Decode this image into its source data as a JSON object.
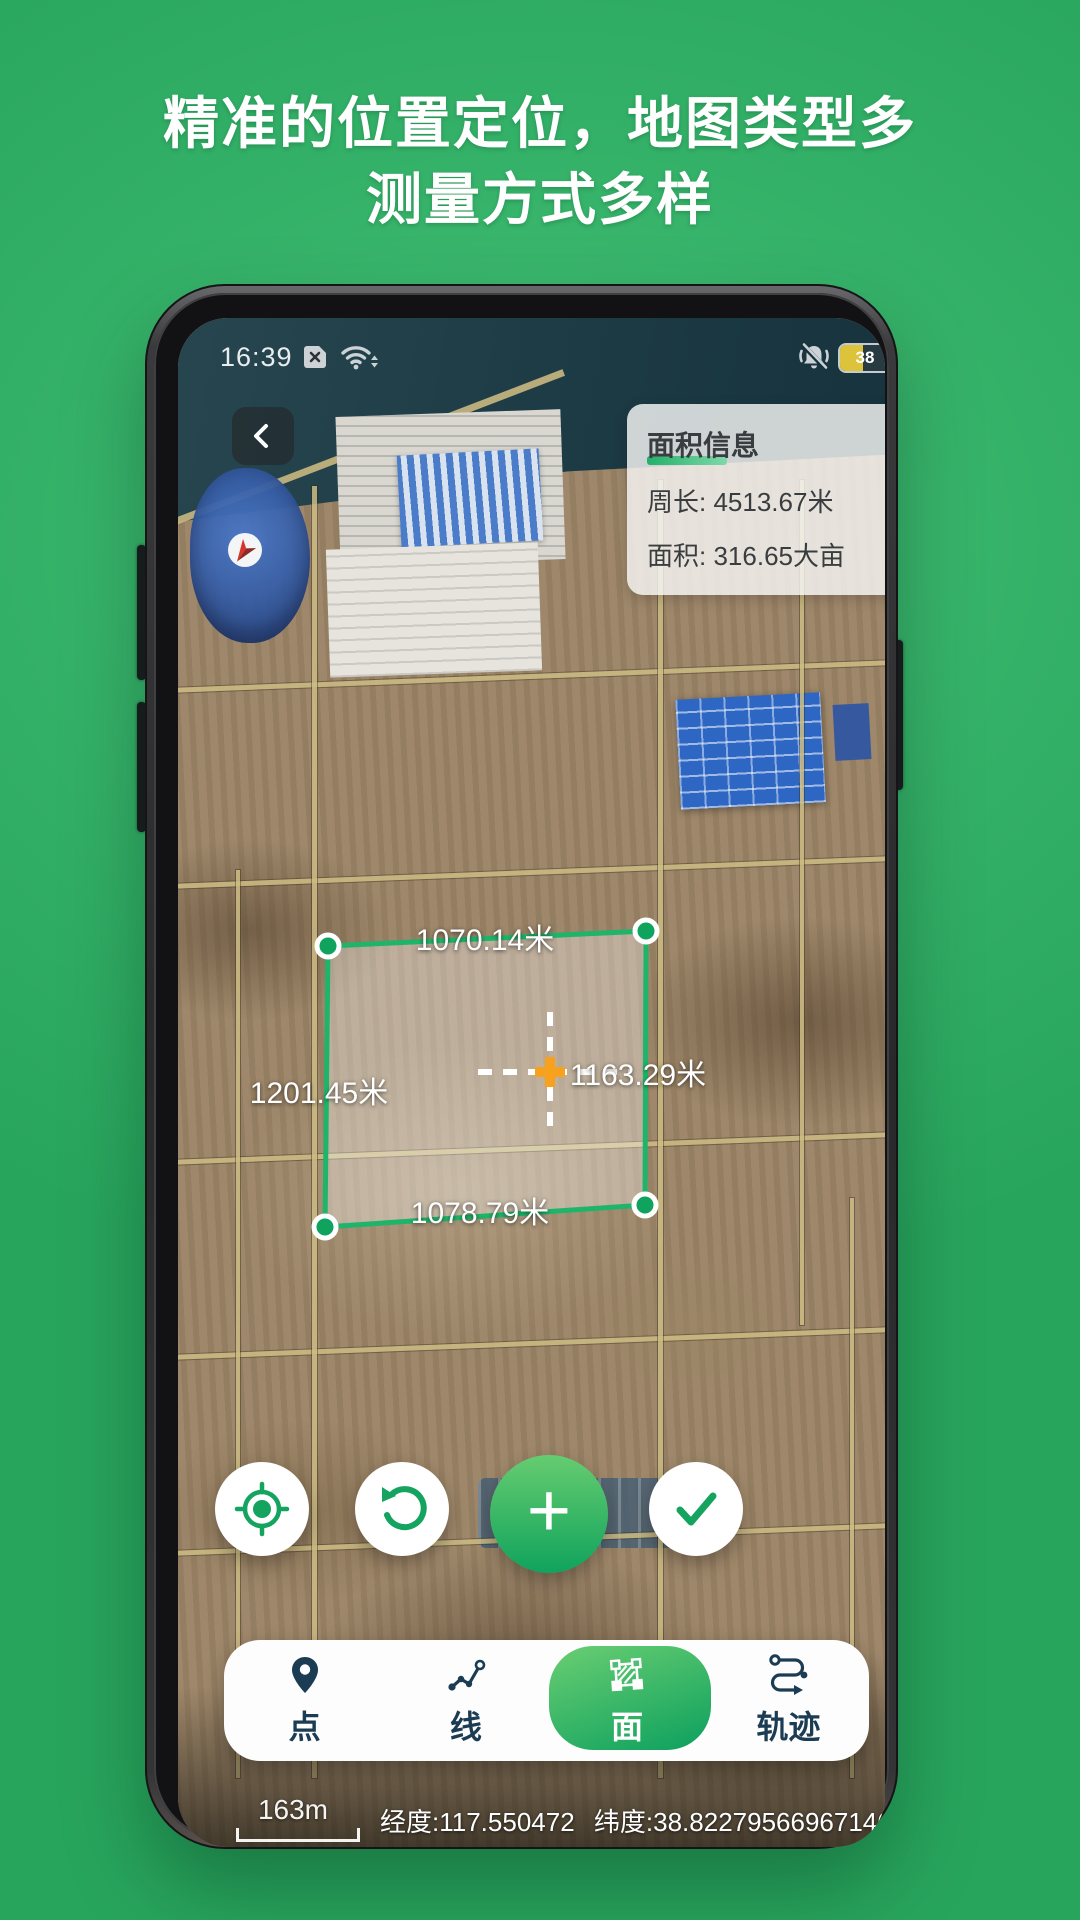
{
  "hero": {
    "title_line1": "精准的位置定位，地图类型多",
    "title_line2": "测量方式多样"
  },
  "status_bar": {
    "time": "16:39",
    "battery_percent": "38"
  },
  "map": {
    "info_panel": {
      "title": "面积信息",
      "perimeter_label": "周长:",
      "perimeter_value": "4513.67米",
      "area_label": "面积:",
      "area_value": "316.65大亩"
    },
    "measurements": {
      "top_edge": "1070.14米",
      "left_edge": "1201.45米",
      "center": "1163.29米",
      "bottom_edge": "1078.79米"
    },
    "footer": {
      "scale": "163m",
      "longitude": "经度:117.550472",
      "latitude": "纬度:38.822795669671464"
    }
  },
  "nav": {
    "active_index": 2,
    "tabs": [
      {
        "label": "点",
        "icon": "map-pin"
      },
      {
        "label": "线",
        "icon": "polyline"
      },
      {
        "label": "面",
        "icon": "polygon"
      },
      {
        "label": "轨迹",
        "icon": "route"
      }
    ]
  },
  "icons": {
    "back": "chevron-left",
    "sim": "sim-missing",
    "wifi": "wifi",
    "mute": "ringer-off",
    "battery": "battery",
    "locate": "gps-target",
    "undo": "rotate-ccw",
    "add": "plus",
    "confirm": "check",
    "center_marker": "orange-plus-crosshair"
  },
  "colors": {
    "page_green": "#2fae63",
    "page_green_light": "#46c177",
    "accent_green": "#16a75f",
    "polygon_stroke": "#1eb469",
    "nav_active_from": "#6ace72",
    "nav_active_to": "#0ca05e",
    "nav_text": "#1b3c53",
    "marker_orange": "#f7a11c",
    "battery_fill": "#ddc33c"
  }
}
